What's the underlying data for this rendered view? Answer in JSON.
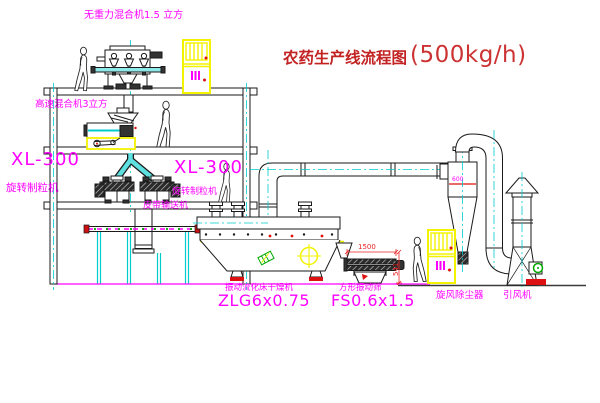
{
  "title": {
    "name_cn": "农药生产线流程图",
    "capacity": "(500kg/h)"
  },
  "labels": {
    "gravityless_mixer": "无重力混合机1.5 立方",
    "high_speed_mixer": "高速混合机3立方",
    "xl300_left": "XL-300",
    "granulator_left": "旋转制粒机",
    "xl300_center": "XL-300",
    "granulator_center": "旋转制粒机",
    "belt_conveyor": "皮带输送机",
    "dryer_name": "振动流化床干燥机",
    "dryer_model": "ZLG6x0.75",
    "sieve_name": "方形振动筛",
    "sieve_model": "FS0.6x1.5",
    "cyclone": "旋风除尘器",
    "fan": "引风机"
  },
  "dimensions": {
    "sieve_length_mm": "1500",
    "sieve_height_mm": "541",
    "cyclone_mark": "600"
  },
  "colors": {
    "label_magenta": "#ff00ff",
    "title_red": "#cc2222",
    "dimension_red": "#ee2222",
    "centerline_cyan": "#00cccc",
    "highlight_yellow": "#f5f500",
    "line_black": "#1a1a1a",
    "valve_green": "#00aa00",
    "support_red": "#dd1111"
  }
}
